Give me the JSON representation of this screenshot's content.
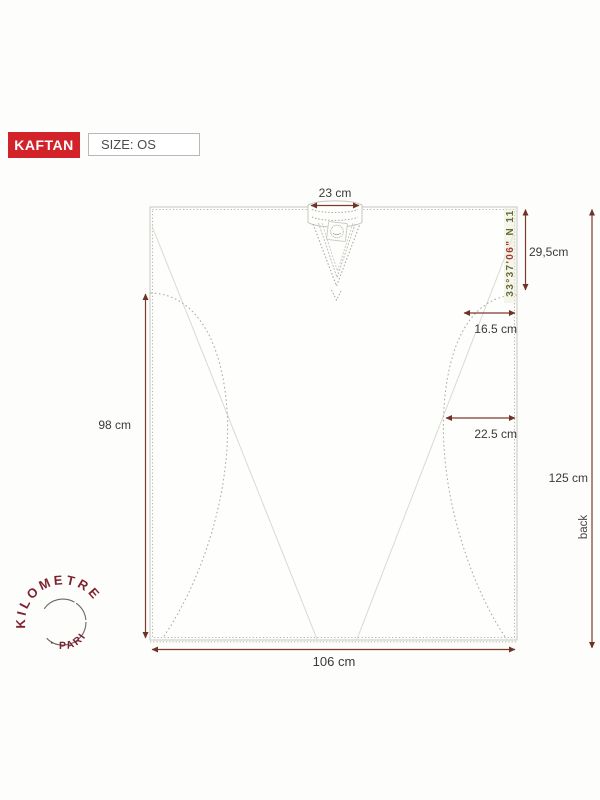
{
  "header": {
    "product": "KAFTAN",
    "size": "SIZE: OS"
  },
  "diagram": {
    "title": "kaftan flat sketch with measurements",
    "labels": {
      "neck_width": "23 cm",
      "neck_drop": "29,5cm",
      "upper_side_inset": "16.5 cm",
      "lower_side_inset": "22.5 cm",
      "side_length": "98 cm",
      "back_length": "125 cm",
      "back_word": "back",
      "hem_width": "106 cm"
    },
    "gps_text": {
      "prefix": "33°37'",
      "highlight": "06\"",
      "suffix": " N 11"
    }
  },
  "stamp": {
    "arc_text": "KILOMETRE",
    "bottom_text": "· PARIS"
  },
  "colors": {
    "badge_red": "#d2232a",
    "dimension_arrow": "#7d3a2c",
    "label_text": "#3a3a3a",
    "garment_outline": "#c6c6c0",
    "seam_dotted": "#a7a79e",
    "fold_faint": "#dadad3",
    "stamp_red": "#7e2231",
    "gps_olive": "#6a6a35",
    "gps_red": "#a03c30"
  }
}
